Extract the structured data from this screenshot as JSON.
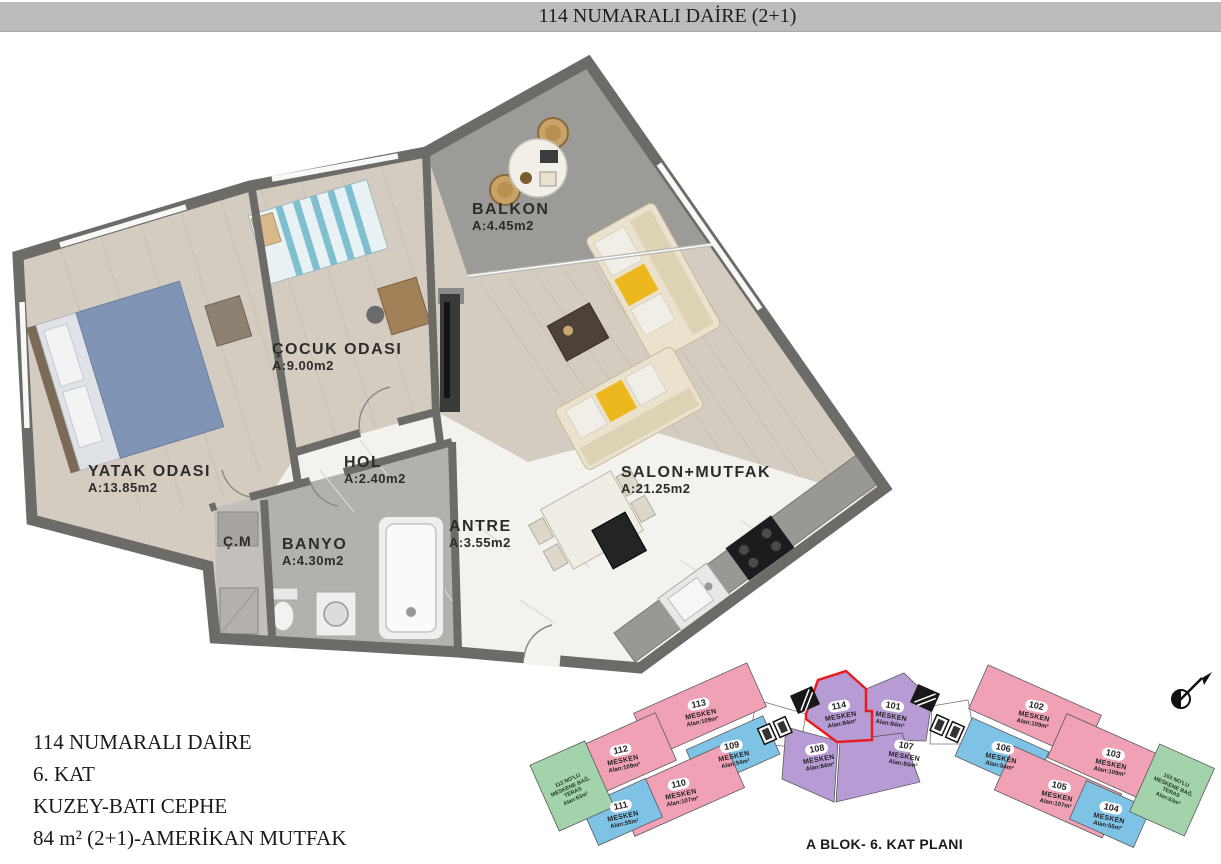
{
  "title_bar": {
    "text": "114 NUMARALI DAİRE (2+1)"
  },
  "floor_plan": {
    "rooms": [
      {
        "id": "yatak",
        "name": "YATAK ODASI",
        "area": "A:13.85m2"
      },
      {
        "id": "cocuk",
        "name": "ÇOCUK ODASI",
        "area": "A:9.00m2"
      },
      {
        "id": "balkon",
        "name": "BALKON",
        "area": "A:4.45m2"
      },
      {
        "id": "hol",
        "name": "HOL",
        "area": "A:2.40m2"
      },
      {
        "id": "antre",
        "name": "ANTRE",
        "area": "A:3.55m2"
      },
      {
        "id": "banyo",
        "name": "BANYO",
        "area": "A:4.30m2"
      },
      {
        "id": "cm",
        "name": "Ç.M",
        "area": ""
      },
      {
        "id": "salon",
        "name": "SALON+MUTFAK",
        "area": "A:21.25m2"
      }
    ]
  },
  "info_block": {
    "lines": [
      "114 NUMARALI DAİRE",
      "6. KAT",
      "KUZEY-BATI CEPHE",
      "84 m² (2+1)-AMERİKAN MUTFAK"
    ]
  },
  "key_plan": {
    "caption": "A BLOK- 6. KAT PLANI",
    "highlighted_unit": "114",
    "units": [
      {
        "number": "113",
        "label": "MESKEN",
        "area": "Alan:109m²",
        "type": "pink"
      },
      {
        "number": "112",
        "label": "MESKEN",
        "area": "Alan:109m²",
        "type": "pink"
      },
      {
        "number": "109",
        "label": "MESKEN",
        "area": "Alan:54m²",
        "type": "blue"
      },
      {
        "number": "110",
        "label": "MESKEN",
        "area": "Alan:107m²",
        "type": "pink"
      },
      {
        "number": "111",
        "label": "MESKEN",
        "area": "Alan:55m²",
        "type": "blue"
      },
      {
        "number": "114",
        "label": "MESKEN",
        "area": "Alan:84m²",
        "type": "purple-highlight"
      },
      {
        "number": "101",
        "label": "MESKEN",
        "area": "Alan:84m²",
        "type": "purple"
      },
      {
        "number": "108",
        "label": "MESKEN",
        "area": "Alan:84m²",
        "type": "purple"
      },
      {
        "number": "107",
        "label": "MESKEN",
        "area": "Alan:84m²",
        "type": "purple"
      },
      {
        "number": "102",
        "label": "MESKEN",
        "area": "Alan:109m²",
        "type": "pink"
      },
      {
        "number": "106",
        "label": "MESKEN",
        "area": "Alan:54m²",
        "type": "blue"
      },
      {
        "number": "103",
        "label": "MESKEN",
        "area": "Alan:109m²",
        "type": "pink"
      },
      {
        "number": "105",
        "label": "MESKEN",
        "area": "Alan:107m²",
        "type": "pink"
      },
      {
        "number": "104",
        "label": "MESKEN",
        "area": "Alan:55m²",
        "type": "blue"
      }
    ],
    "teras_left": {
      "lines": [
        "112 NO'LU",
        "MESKENE BAĞ.",
        "TERAS",
        "Alan:63m²"
      ]
    },
    "teras_right": {
      "lines": [
        "103 NO'LU",
        "MESKENE BAĞ.",
        "TERAS",
        "Alan:63m²"
      ]
    }
  },
  "colors": {
    "title_bar_bg": "#bdbcba",
    "wall": "#6c6b68",
    "wood_floor": "#d5ccc1",
    "marble_floor": "#f3f2ef",
    "tile_floor": "#b3b1ad",
    "balcony_floor": "#9c9b97",
    "unit_pink": "#f0a1b6",
    "unit_blue": "#7ec3e6",
    "unit_purple": "#b79bd4",
    "unit_green": "#a3d3aa",
    "highlight_red": "#e71d1f"
  }
}
